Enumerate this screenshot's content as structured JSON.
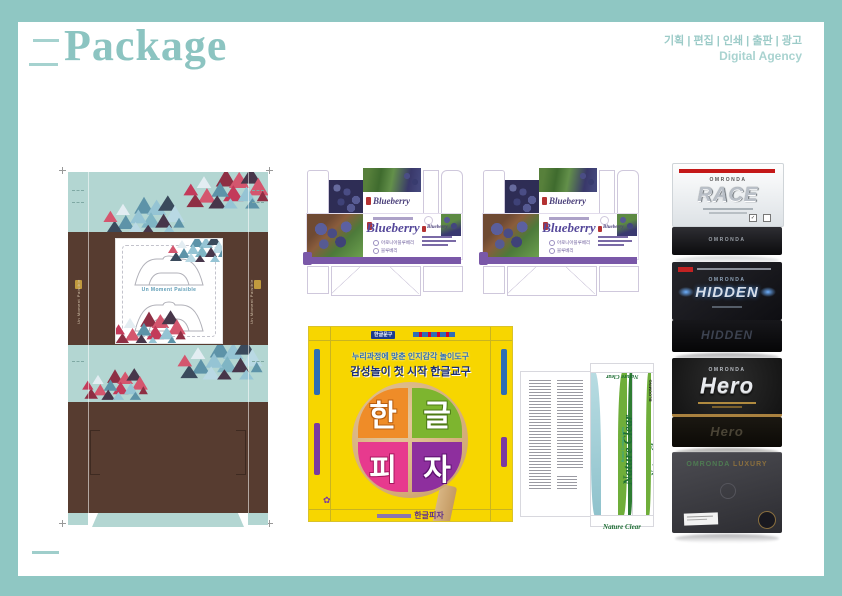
{
  "colors": {
    "frame": "#8fc7c3",
    "accent_teal": "#8cc4c1",
    "purple_band": "#7a58a8",
    "yellow": "#f7d600",
    "brown": "#573c30",
    "mint": "#b3d6d2"
  },
  "header": {
    "title": "Package",
    "services": "기획 | 편집 | 인쇄 | 출판 | 광고",
    "agency": "Digital Agency"
  },
  "tissue_box": {
    "label": "Un Moment Paisible",
    "side_label": "Un Moment Paisible"
  },
  "blueberry": {
    "script": "Blueberry",
    "option1": "아로니아블루베리",
    "option2": "블루베리"
  },
  "hangul_pizza": {
    "top_badge": "한글문구",
    "tagline1": "누리과정에 맞춘 인지감각 놀이도구",
    "tagline2": "감성놀이 첫 시작 한글교구",
    "letters": [
      "한",
      "글",
      "피",
      "자"
    ],
    "product_name": "한글피자",
    "logo_glyph": "✿"
  },
  "nature_clear": {
    "name": "Nature Clear",
    "subtitle": "Brand Contact Lens",
    "brand": "BLOOMING"
  },
  "boxes": [
    {
      "brand": "OMRONDA",
      "name": "RACE",
      "base_label": "OMRONDA"
    },
    {
      "brand": "OMRONDA",
      "name": "HIDDEN",
      "base_label": "HIDDEN"
    },
    {
      "brand": "OMRONDA",
      "name": "Hero",
      "base_label": "Hero"
    },
    {
      "brand": "OMRONDA",
      "name": "LUXURY",
      "base_label": ""
    }
  ],
  "check_glyph": "✓"
}
